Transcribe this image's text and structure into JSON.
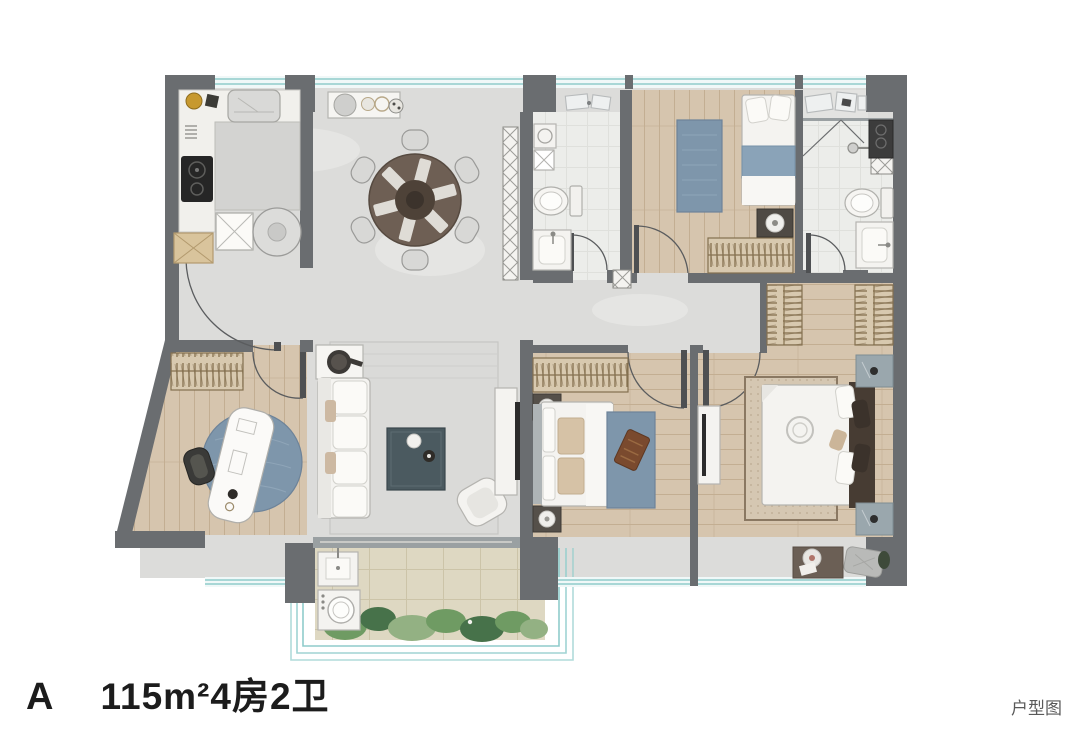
{
  "page": {
    "background": "#ffffff",
    "width": 1080,
    "height": 734
  },
  "footer": {
    "unit_letter": "A",
    "unit_spec": "115m²4房2卫",
    "caption": "户型图"
  },
  "palette": {
    "wall": "#6a6d70",
    "wallLight": "#9aa0a2",
    "marble": "#dcdcda",
    "marbleVein": "#e7e7e5",
    "marbleDark": "#d2d2d0",
    "wood": "#d6c5ae",
    "plank": "#c3ae92",
    "bath": "#ecedea",
    "tile": "#ded8c2",
    "tileLine": "#ccc4a8",
    "window": "#8fcccb",
    "windowFill": "#f0f8f8",
    "hatchFill": "#d8c9af",
    "hatchLine": "#84704f",
    "rugBlue": "#7e96ab",
    "rugBeige": "#d5c7b2",
    "rugLiving": "#dadad8",
    "furnWhite": "#f4f3f0",
    "furnStroke": "#b5b4b0",
    "tableDark": "#4b5a60",
    "headboard": "#473c33",
    "nightstand": "#9aa7ad",
    "woodFurn": "#6e5f54",
    "green": "#6f9b63",
    "greenDark": "#47724a",
    "greenLight": "#93b183",
    "gold": "#c7992f",
    "black": "#262626",
    "sketch": "#b7babb",
    "doorStroke": "#5a5c5e",
    "text": "#1c1c1c",
    "caption": "#595959"
  },
  "plan": {
    "room_names": [
      "entry-hall",
      "kitchen",
      "dining-room",
      "living-room",
      "study",
      "bedroom-2",
      "bedroom-3",
      "master-bedroom",
      "bathroom-1",
      "bathroom-2",
      "corridor",
      "living-balcony",
      "bedroom-balcony",
      "laundry-balcony"
    ]
  }
}
